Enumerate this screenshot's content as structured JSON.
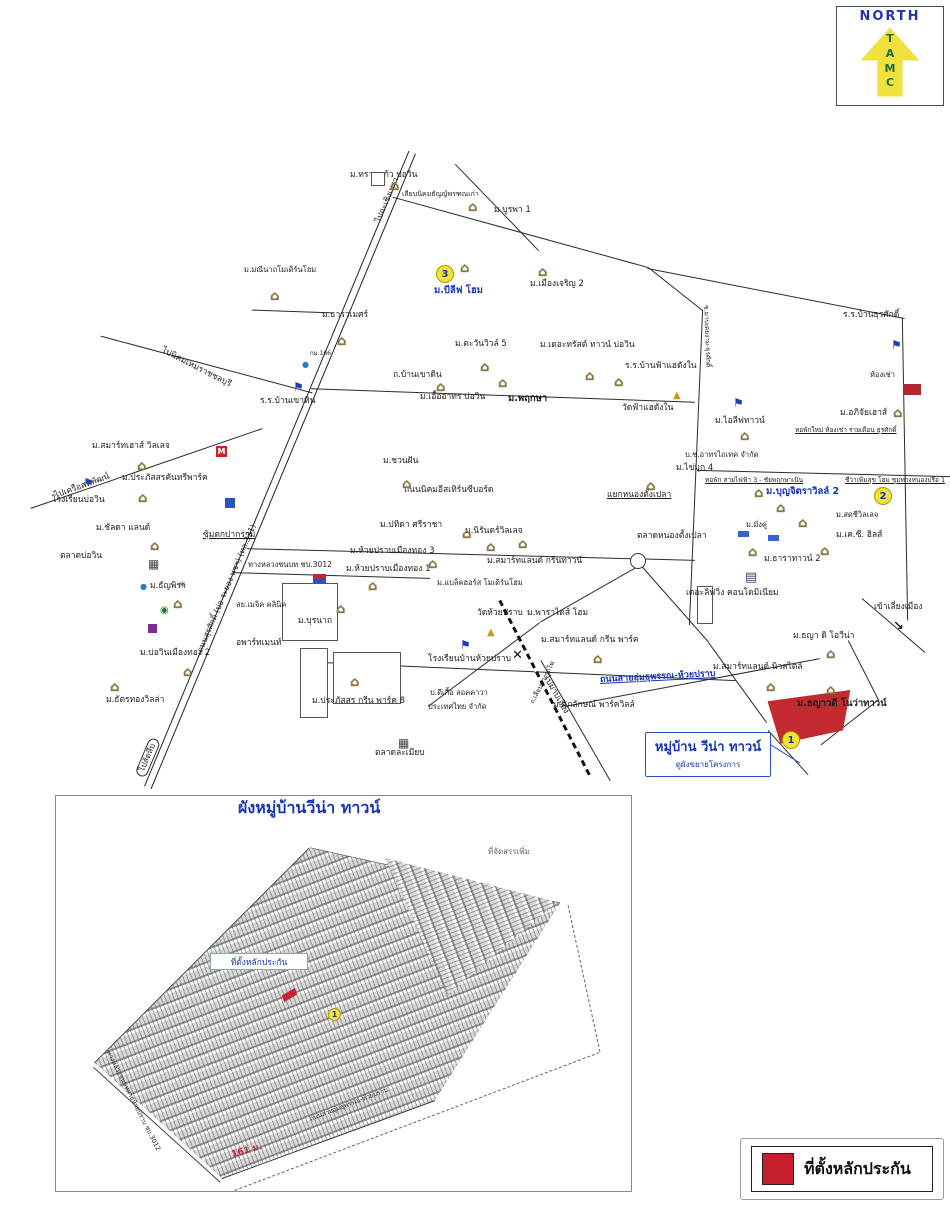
{
  "colors": {
    "blue": "#1636b8",
    "red": "#c82333",
    "yellow": "#f2e437",
    "roof": "#8a7840",
    "green": "#1c6b3c"
  },
  "compass": {
    "title": "NORTH",
    "letters": [
      "T",
      "A",
      "M",
      "C"
    ]
  },
  "map": {
    "callout": {
      "title": "หมู่บ้าน วีน่า ทาวน์",
      "subtitle": "ดูผังขยายโครงการ"
    },
    "markers": [
      {
        "n": "3",
        "x": 436,
        "y": 265
      },
      {
        "n": "2",
        "x": 874,
        "y": 487
      },
      {
        "n": "1",
        "x": 782,
        "y": 731
      }
    ],
    "labels": [
      {
        "t": "ม.ทรายแก้ว บ่อวิน",
        "x": 350,
        "y": 171
      },
      {
        "t": "เลียบนิคมธัญญ์พรฑณเก่า",
        "x": 402,
        "y": 191,
        "s": 7
      },
      {
        "t": "ม.บูรพา 1",
        "x": 494,
        "y": 206
      },
      {
        "t": "ม.บีลีฟ โฮม",
        "x": 434,
        "y": 286,
        "s": 9.5,
        "c": "b",
        "b": 1
      },
      {
        "t": "ม.เมืองเจริญ 2",
        "x": 530,
        "y": 280
      },
      {
        "t": "ม.มณีนาถโมเดิร์นโฮม",
        "x": 244,
        "y": 266,
        "s": 7.5
      },
      {
        "t": "ม.ธาราเมศร์",
        "x": 322,
        "y": 311
      },
      {
        "t": "ม.ตะวันวิวล์ 5",
        "x": 455,
        "y": 340
      },
      {
        "t": "ม.เดอะทรัสต์ ทาวน์ บ่อวิน",
        "x": 540,
        "y": 341
      },
      {
        "t": "ร.ร.บ้านฟ้าแฮดังใน",
        "x": 625,
        "y": 362
      },
      {
        "t": "วัดฟ้าแฮดังใน",
        "x": 622,
        "y": 404
      },
      {
        "t": "ม.เอื้ออาทร บ่อวิน",
        "x": 420,
        "y": 393
      },
      {
        "t": "ม.พฤกษา",
        "x": 508,
        "y": 394,
        "s": 9.5,
        "b": 1
      },
      {
        "t": "ร.ร.บ้านธุรศักดิ์",
        "x": 843,
        "y": 311
      },
      {
        "t": "ห้องเช่า",
        "x": 870,
        "y": 371,
        "s": 7.5
      },
      {
        "t": "ม.อภิจัยเฮาส์",
        "x": 840,
        "y": 409
      },
      {
        "t": "หอพักใหม่ ห้องเช่า รายเดือน ธุรศักดิ์",
        "x": 795,
        "y": 427,
        "s": 6.5,
        "u": 1
      },
      {
        "t": "ม.ไอลีฟทาวน์",
        "x": 715,
        "y": 417
      },
      {
        "t": "บ.ช.อาทรไถเทค จำกัด",
        "x": 685,
        "y": 451,
        "s": 7.5
      },
      {
        "t": "ม.ไข่มุก 4",
        "x": 676,
        "y": 464
      },
      {
        "t": "หอพัก สายไฟฟ้า 3 - ชัยพฤกษาเนิน",
        "x": 705,
        "y": 477,
        "s": 6.5,
        "u": 1
      },
      {
        "t": "ชีวาเพิ่มสุข โฮม ชุมทางหนองปรือ 1",
        "x": 845,
        "y": 477,
        "s": 6.5,
        "u": 1
      },
      {
        "t": "ม.ชวนฝัน",
        "x": 383,
        "y": 457
      },
      {
        "t": "ถนนนิคมอีสเทิร์นซีบอร์ด",
        "x": 404,
        "y": 486
      },
      {
        "t": "กม.166",
        "x": 310,
        "y": 351,
        "s": 6
      },
      {
        "t": "ม.ปทิดา ศรีราชา",
        "x": 380,
        "y": 521
      },
      {
        "t": "ม.นิรันดร์วิลเลจ",
        "x": 465,
        "y": 527
      },
      {
        "t": "ม.ห้วยปราบเมืองทอง 3",
        "x": 350,
        "y": 547
      },
      {
        "t": "ม.ห้วยปราบเมืองทอง 1",
        "x": 346,
        "y": 565
      },
      {
        "t": "ม.สมาร์ทแลนด์ กรีนทาวน์",
        "x": 487,
        "y": 557
      },
      {
        "t": "ม.แบล็คฮอร์ส โมเดิร์นโฮม",
        "x": 437,
        "y": 579,
        "s": 7.5
      },
      {
        "t": "ม.ธัญพิรา",
        "x": 150,
        "y": 582
      },
      {
        "t": "แยกหนองตั้งเปลา",
        "x": 607,
        "y": 491,
        "u": 1
      },
      {
        "t": "ตลาดหนองตั้งเปลา",
        "x": 637,
        "y": 532
      },
      {
        "t": "ม.บุญจิตราวิลล์ 2",
        "x": 766,
        "y": 487,
        "s": 9.5,
        "c": "b",
        "b": 1
      },
      {
        "t": "ม.สดชีวิลเลจ",
        "x": 836,
        "y": 511,
        "s": 7.5
      },
      {
        "t": "ม.เค.ซี. ฮิลส์",
        "x": 836,
        "y": 531
      },
      {
        "t": "ม.มั่งคู่",
        "x": 746,
        "y": 521,
        "s": 7.5
      },
      {
        "t": "ม.ธาราทาวน์ 2",
        "x": 764,
        "y": 555
      },
      {
        "t": "เดอะลิฟวิ่ง คอนโดมิเนียม",
        "x": 686,
        "y": 589
      },
      {
        "t": "เข้าเลี่ยงเมือง",
        "x": 874,
        "y": 603
      },
      {
        "t": "ม.ธญา ดิ โอวีน่า",
        "x": 793,
        "y": 632
      },
      {
        "t": "ม.ธญาวดี โนว่าทาวน์",
        "x": 797,
        "y": 699,
        "s": 9.5,
        "b": 1
      },
      {
        "t": "ม.สมาร์ทแลนด์ นิวสไตล์",
        "x": 713,
        "y": 663
      },
      {
        "t": "วัดห้วยปราบ",
        "x": 477,
        "y": 609
      },
      {
        "t": "ม.พาราไดส์ โฮม",
        "x": 527,
        "y": 609
      },
      {
        "t": "ม.สมาร์ทแลนด์ กรีน พาร์ค",
        "x": 541,
        "y": 636
      },
      {
        "t": "โรงเรียนบ้านห้วยปราบ",
        "x": 428,
        "y": 655
      },
      {
        "t": "บ.ดีเกื้อ ลอคคาวา",
        "x": 430,
        "y": 689,
        "s": 7.5
      },
      {
        "t": "ประเทศไทย จำกัด",
        "x": 428,
        "y": 703,
        "s": 7.5
      },
      {
        "t": "ม.ศุภลักษณ์ พาร์ควิลล์",
        "x": 553,
        "y": 701
      },
      {
        "t": "ตลาดละเมียบ",
        "x": 375,
        "y": 749
      },
      {
        "t": "ม.บุรนาถ",
        "x": 298,
        "y": 617
      },
      {
        "t": "อพาร์ทเมนท์",
        "x": 236,
        "y": 639
      },
      {
        "t": "สย.เมจิค คลินิค",
        "x": 236,
        "y": 601,
        "s": 7.5
      },
      {
        "t": "ม.บ่อวินเมืองทอง 2",
        "x": 140,
        "y": 649
      },
      {
        "t": "ม.ธัตรทองวิลล่า",
        "x": 106,
        "y": 696
      },
      {
        "t": "ม.ประภัสสร กรีน พาร์ค 8",
        "x": 312,
        "y": 697
      },
      {
        "t": "ม.สมาร์ทเฮาส์ วิลเลจ",
        "x": 92,
        "y": 442
      },
      {
        "t": "โรงเรียนบ่อวิน",
        "x": 52,
        "y": 496
      },
      {
        "t": "ม.ประภัสสรคันทรีพาร์ค",
        "x": 122,
        "y": 474
      },
      {
        "t": "ม.ชัลดา แลนด์",
        "x": 96,
        "y": 524
      },
      {
        "t": "ตลาดบ่อวิน",
        "x": 60,
        "y": 552
      },
      {
        "t": "ซุ้มตกปากร่วม",
        "x": 203,
        "y": 531,
        "u": 1
      },
      {
        "t": "ร.ร.บ้านเขาหิน",
        "x": 260,
        "y": 397
      },
      {
        "t": "ถ.บ้านเขาดิน",
        "x": 393,
        "y": 371
      },
      {
        "t": "ทางหลวงชนบท ชบ.3012",
        "x": 248,
        "y": 561,
        "s": 7.5
      },
      {
        "t": "ถนนสุรศักดิ์ (บ่อ-ระยอง ทชฯ) (ทล.331)",
        "x": 200,
        "y": 648,
        "s": 8,
        "r": -67
      },
      {
        "t": "ไปฉะเชิงเทรา",
        "x": 378,
        "y": 218,
        "s": 8,
        "r": -67
      },
      {
        "t": "ไปนิคมเหมราชชลบุรี",
        "x": 162,
        "y": 346,
        "r": 27
      },
      {
        "t": "ไปเครือสหพัฒน์",
        "x": 55,
        "y": 492,
        "r": -20
      },
      {
        "t": "ไปสัตหีบ",
        "x": 140,
        "y": 770,
        "s": 8,
        "r": -67,
        "bx": 1
      },
      {
        "t": "ไปมาบเอียง",
        "x": 545,
        "y": 672,
        "r": 60
      },
      {
        "t": "ซ.มาบเตยงาม-ธุรศักดิ์",
        "x": 706,
        "y": 302,
        "s": 6.5,
        "r": 88
      },
      {
        "t": "ถ.เลียบทางรถไฟ",
        "x": 532,
        "y": 700,
        "s": 6.5,
        "r": -63
      },
      {
        "t": "ถนนสายอุ่มธุพรรณ-ห้วยปราบ",
        "x": 600,
        "y": 676,
        "s": 9,
        "c": "b",
        "b": 1,
        "u": 1,
        "r": -3
      }
    ],
    "houses": [
      [
        390,
        180
      ],
      [
        468,
        201
      ],
      [
        460,
        262
      ],
      [
        538,
        266
      ],
      [
        270,
        290
      ],
      [
        337,
        335
      ],
      [
        480,
        361
      ],
      [
        585,
        370
      ],
      [
        614,
        376
      ],
      [
        436,
        381
      ],
      [
        498,
        377
      ],
      [
        740,
        430
      ],
      [
        646,
        480
      ],
      [
        402,
        478
      ],
      [
        137,
        460
      ],
      [
        138,
        492
      ],
      [
        150,
        540
      ],
      [
        173,
        598
      ],
      [
        336,
        603
      ],
      [
        183,
        666
      ],
      [
        110,
        681
      ],
      [
        350,
        676
      ],
      [
        428,
        558
      ],
      [
        368,
        580
      ],
      [
        486,
        541
      ],
      [
        518,
        538
      ],
      [
        754,
        487
      ],
      [
        776,
        502
      ],
      [
        798,
        517
      ],
      [
        820,
        545
      ],
      [
        748,
        546
      ],
      [
        766,
        681
      ],
      [
        826,
        648
      ],
      [
        826,
        684
      ],
      [
        593,
        653
      ],
      [
        893,
        407
      ],
      [
        462,
        528
      ]
    ],
    "pois": [
      {
        "t": "school",
        "x": 83,
        "y": 477
      },
      {
        "t": "school",
        "x": 293,
        "y": 381
      },
      {
        "t": "school",
        "x": 733,
        "y": 397
      },
      {
        "t": "school",
        "x": 891,
        "y": 339
      },
      {
        "t": "school",
        "x": 460,
        "y": 639
      },
      {
        "t": "temple",
        "x": 673,
        "y": 391
      },
      {
        "t": "temple",
        "x": 487,
        "y": 628
      },
      {
        "t": "market",
        "x": 148,
        "y": 558
      },
      {
        "t": "market",
        "x": 398,
        "y": 737
      },
      {
        "t": "mcd",
        "x": 216,
        "y": 446
      },
      {
        "t": "blue",
        "x": 225,
        "y": 498
      },
      {
        "t": "purple",
        "x": 148,
        "y": 624
      },
      {
        "t": "bank",
        "x": 160,
        "y": 606
      },
      {
        "t": "drop",
        "x": 302,
        "y": 361
      },
      {
        "t": "drop",
        "x": 140,
        "y": 583
      },
      {
        "t": "spark",
        "x": 178,
        "y": 581
      },
      {
        "t": "truck",
        "x": 738,
        "y": 531
      },
      {
        "t": "truck",
        "x": 768,
        "y": 535
      },
      {
        "t": "building",
        "x": 745,
        "y": 571
      },
      {
        "t": "redbldg",
        "x": 903,
        "y": 384
      },
      {
        "t": "sign",
        "x": 313,
        "y": 574
      },
      {
        "t": "rail",
        "x": 512,
        "y": 649
      },
      {
        "t": "arrow",
        "x": 893,
        "y": 620
      },
      {
        "t": "sq",
        "x": 371,
        "y": 172
      }
    ]
  },
  "plan": {
    "collateral_label": "ที่ตั้งหลักประกัน",
    "marker": {
      "n": "1",
      "x": 328,
      "y": 1008
    },
    "labels": [
      {
        "t": "ผังหมู่บ้านวีน่า ทาวน์",
        "x": 238,
        "y": 800,
        "s": 16,
        "c": "b",
        "b": 1
      },
      {
        "t": "ที่จัดสรรเพิ่ม",
        "x": 488,
        "y": 848,
        "s": 8,
        "c": "g"
      },
      {
        "t": "161 ม.",
        "x": 232,
        "y": 1151,
        "s": 9,
        "c": "r",
        "b": 1,
        "r": -15
      },
      {
        "t": "ทางหลวงชนบทสายห้วยปราบ ชบ.3012",
        "x": 108,
        "y": 1048,
        "s": 6.5,
        "r": 63
      },
      {
        "t": "ถนนสายอุ่มธุพรรณ-ห้วยปราบ",
        "x": 310,
        "y": 1116,
        "s": 6.5,
        "r": -21
      }
    ]
  },
  "legend": {
    "label": "ที่ตั้งหลักประกัน"
  }
}
